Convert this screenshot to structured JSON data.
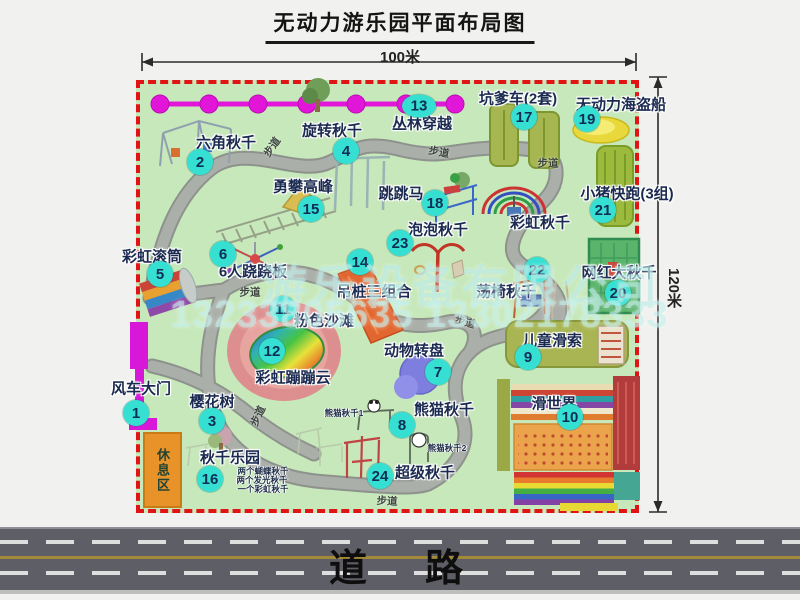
{
  "title": "无动力游乐园平面布局图",
  "dimensions": {
    "top": "100米",
    "right": "120米"
  },
  "road": {
    "label": "道路"
  },
  "rest_area": {
    "label": "休息区"
  },
  "watermark": {
    "company": "游乐设备有限公司",
    "phone": "13233805635 13302178333"
  },
  "trail": {
    "label": "步道",
    "positions": [
      {
        "x": 272,
        "y": 147,
        "r": -55
      },
      {
        "x": 439,
        "y": 152,
        "r": 10
      },
      {
        "x": 548,
        "y": 163,
        "r": 0
      },
      {
        "x": 250,
        "y": 292,
        "r": 0
      },
      {
        "x": 258,
        "y": 416,
        "r": -65
      },
      {
        "x": 465,
        "y": 322,
        "r": 15
      },
      {
        "x": 387,
        "y": 501,
        "r": 3
      }
    ]
  },
  "palette": {
    "border_dashed": "#e01414",
    "ground_green": "#c6e8ba",
    "badge_cyan": "#35dfd2",
    "gate_magenta": "#d818d8",
    "chain_magenta": "#e216d8",
    "road_gray": "#5e5e66",
    "rest_orange": "#e8932a"
  },
  "attractions": [
    {
      "num": "1",
      "label": "风车大门",
      "lx": 141,
      "ly": 388,
      "bx": 136,
      "by": 413
    },
    {
      "num": "2",
      "label": "六角秋千",
      "lx": 226,
      "ly": 142,
      "bx": 200,
      "by": 162
    },
    {
      "num": "3",
      "label": "樱花树",
      "lx": 212,
      "ly": 401,
      "bx": 212,
      "by": 421
    },
    {
      "num": "4",
      "label": "旋转秋千",
      "lx": 332,
      "ly": 130,
      "bx": 346,
      "by": 151
    },
    {
      "num": "5",
      "label": "彩虹滚筒",
      "lx": 152,
      "ly": 256,
      "bx": 160,
      "by": 274
    },
    {
      "num": "6",
      "label": "6人跷跷板",
      "lx": 253,
      "ly": 271,
      "bx": 223,
      "by": 254
    },
    {
      "num": "7",
      "label": "动物转盘",
      "lx": 414,
      "ly": 350,
      "bx": 438,
      "by": 372
    },
    {
      "num": "8",
      "label": "熊猫秋千",
      "lx": 444,
      "ly": 409,
      "bx": 402,
      "by": 425
    },
    {
      "num": "9",
      "label": "儿童滑索",
      "lx": 552,
      "ly": 340,
      "bx": 528,
      "by": 357
    },
    {
      "num": "10",
      "label": "滑世界",
      "lx": 554,
      "ly": 403,
      "bx": 570,
      "by": 417
    },
    {
      "num": "11",
      "label": "粉色沙滩",
      "lx": 324,
      "ly": 320,
      "bx": 283,
      "by": 309
    },
    {
      "num": "12",
      "label": "彩虹蹦蹦云",
      "lx": 293,
      "ly": 377,
      "bx": 272,
      "by": 351
    },
    {
      "num": "13",
      "label": "丛林穿越",
      "lx": 422,
      "ly": 123,
      "bx": 419,
      "by": 106,
      "wide": true
    },
    {
      "num": "14",
      "label": "吊桩三组合",
      "lx": 374,
      "ly": 291,
      "bx": 360,
      "by": 262
    },
    {
      "num": "15",
      "label": "勇攀高峰",
      "lx": 303,
      "ly": 186,
      "bx": 311,
      "by": 209
    },
    {
      "num": "16",
      "label": "秋千乐园",
      "lx": 230,
      "ly": 457,
      "bx": 210,
      "by": 479
    },
    {
      "num": "17",
      "label": "坑爹车(2套)",
      "lx": 518,
      "ly": 98,
      "bx": 524,
      "by": 117
    },
    {
      "num": "18",
      "label": "跳跳马",
      "lx": 401,
      "ly": 193,
      "bx": 435,
      "by": 203
    },
    {
      "num": "19",
      "label": "无动力海盗船",
      "lx": 621,
      "ly": 104,
      "bx": 587,
      "by": 119
    },
    {
      "num": "20",
      "label": "网红大秋千",
      "lx": 619,
      "ly": 272,
      "bx": 618,
      "by": 293
    },
    {
      "num": "21",
      "label": "小猪快跑(3组)",
      "lx": 627,
      "ly": 193,
      "bx": 603,
      "by": 210
    },
    {
      "num": "22",
      "label": "荡椅秋千",
      "lx": 506,
      "ly": 291,
      "bx": 537,
      "by": 270
    },
    {
      "num": "23",
      "label": "泡泡秋千",
      "lx": 438,
      "ly": 229,
      "bx": 400,
      "by": 243
    },
    {
      "num": "24",
      "label": "超级秋千",
      "lx": 425,
      "ly": 472,
      "bx": 380,
      "by": 476
    },
    {
      "num": null,
      "label": "彩虹秋千",
      "lx": 540,
      "ly": 222,
      "bx": null,
      "by": null
    }
  ],
  "small_labels": [
    {
      "text": "熊猫秋千1",
      "x": 344,
      "y": 413
    },
    {
      "text": "熊猫秋千2",
      "x": 447,
      "y": 448
    },
    {
      "text": "两个蝴蝶秋千",
      "x": 263,
      "y": 471
    },
    {
      "text": "两个发光秋千",
      "x": 262,
      "y": 480
    },
    {
      "text": "一个彩虹秋千",
      "x": 263,
      "y": 489
    }
  ]
}
